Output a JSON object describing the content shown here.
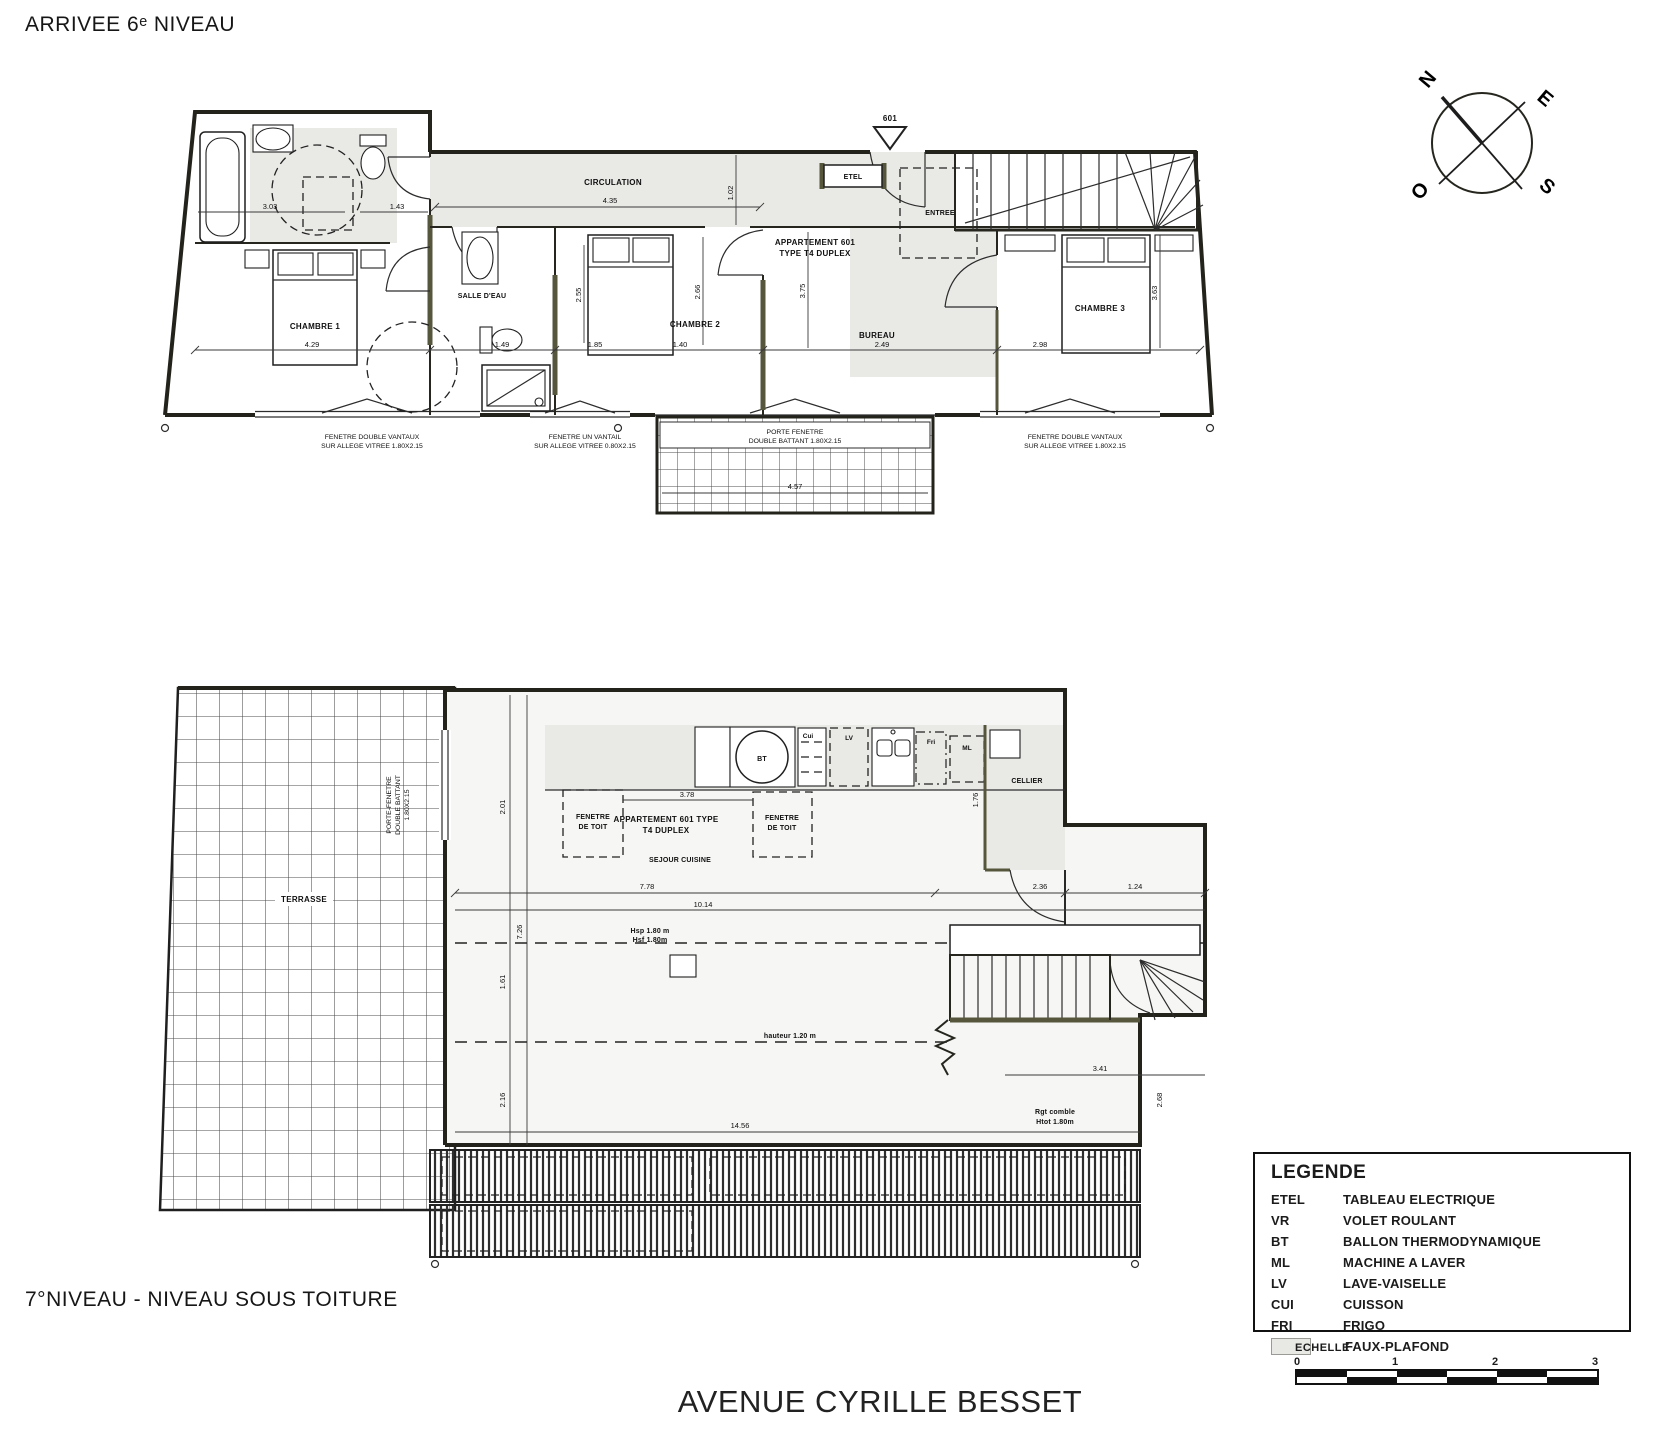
{
  "page": {
    "title_top": "ARRIVEE 6ᵉ NIVEAU",
    "title_bottom": "7°NIVEAU - NIVEAU SOUS TOITURE",
    "street_title": "AVENUE CYRILLE BESSET"
  },
  "compass": {
    "north": "N",
    "east": "E",
    "south": "S",
    "west": "O"
  },
  "upper_plan": {
    "entry_tag": "601",
    "labels": {
      "circulation": "CIRCULATION",
      "salle_deau": "SALLE D'EAU",
      "chambre1": "CHAMBRE 1",
      "chambre2": "CHAMBRE 2",
      "chambre3": "CHAMBRE 3",
      "bureau": "BUREAU",
      "entree": "ENTREE",
      "etel": "ETEL",
      "apartment_line1": "APPARTEMENT 601",
      "apartment_line2": "TYPE T4 DUPLEX"
    },
    "window_notes": {
      "left_line1": "FENETRE DOUBLE VANTAUX",
      "left_line2": "SUR ALLEGE VITREE 1.80X2.15",
      "mid_line1": "FENETRE UN VANTAIL",
      "mid_line2": "SUR ALLEGE VITREE 0.80X2.15",
      "right_line1": "FENETRE DOUBLE VANTAUX",
      "right_line2": "SUR ALLEGE VITREE 1.80X2.15",
      "balcony_line1": "PORTE FENETRE",
      "balcony_line2": "DOUBLE BATTANT 1.80X2.15"
    },
    "dims": {
      "d1": "3.03",
      "d2": "1.43",
      "d3": "4.35",
      "d4": "1.02",
      "d5": "3.75",
      "d6": "2.49",
      "d7": "4.29",
      "d8": "1.49",
      "d9": "1.85",
      "d10": "1.40",
      "d11": "4.57",
      "d12": "2.98",
      "d13": "2.66",
      "d14": "2.55",
      "d15": "3.63"
    }
  },
  "lower_plan": {
    "labels": {
      "terrasse": "TERRASSE",
      "porte_fenetre_line1": "PORTE-FENETRE",
      "porte_fenetre_line2": "DOUBLE BATTANT",
      "porte_fenetre_line3": "1.80X2.15",
      "apartment_line1": "APPARTEMENT 601 TYPE",
      "apartment_line2": "T4 DUPLEX",
      "sejour": "SEJOUR CUISINE",
      "fenetre_toit_line1": "FENETRE",
      "fenetre_toit_line2": "DE TOIT",
      "cellier": "CELLIER",
      "bt": "BT",
      "cui": "Cui",
      "lv": "LV",
      "fri": "Fri",
      "ml": "ML",
      "hsp_line1": "Hsp 1.80 m",
      "hsp_line2": "Hsf 1.80m",
      "hauteur": "hauteur 1.20 m",
      "rgt_line1": "Rgt comble",
      "rgt_line2": "Htot 1.80m"
    },
    "dims": {
      "e1": "7.78",
      "e2": "10.14",
      "e3": "2.36",
      "e4": "1.24",
      "e5": "3.41",
      "e6": "2.68",
      "e7": "2.01",
      "e8": "7.26",
      "e9": "1.61",
      "e10": "2.16",
      "e11": "14.56",
      "e12": "3.78",
      "e13": "1.76"
    }
  },
  "legend": {
    "title": "LEGENDE",
    "items": [
      {
        "abbr": "ETEL",
        "label": "TABLEAU ELECTRIQUE"
      },
      {
        "abbr": "VR",
        "label": "VOLET ROULANT"
      },
      {
        "abbr": "BT",
        "label": "BALLON THERMODYNAMIQUE"
      },
      {
        "abbr": "ML",
        "label": "MACHINE A LAVER"
      },
      {
        "abbr": "LV",
        "label": "LAVE-VAISELLE"
      },
      {
        "abbr": "CUI",
        "label": "CUISSON"
      },
      {
        "abbr": "FRI",
        "label": "FRIGO"
      },
      {
        "abbr": "",
        "label": "FAUX-PLAFOND"
      }
    ]
  },
  "scale_bar": {
    "label": "ECHELLE",
    "ticks": [
      "0",
      "1",
      "2",
      "3"
    ]
  }
}
